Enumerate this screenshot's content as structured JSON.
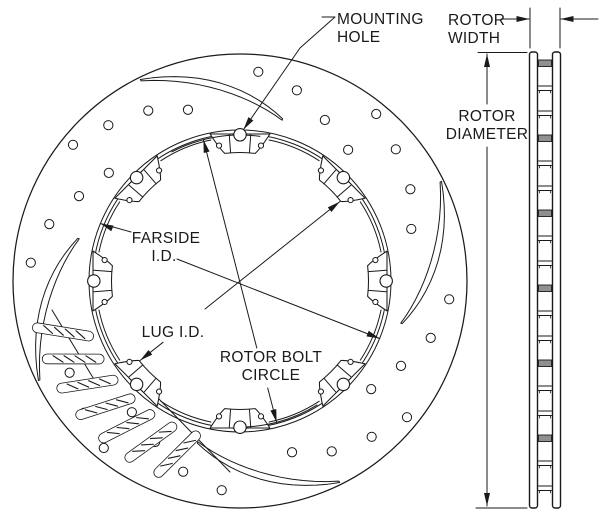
{
  "labels": {
    "mounting_hole": {
      "lines": [
        "MOUNTING",
        "HOLE"
      ]
    },
    "rotor_width": {
      "lines": [
        "ROTOR",
        "WIDTH"
      ]
    },
    "rotor_diameter": {
      "lines": [
        "ROTOR",
        "DIAMETER"
      ]
    },
    "farside_id": {
      "lines": [
        "FARSIDE",
        "I.D."
      ]
    },
    "lug_id": {
      "lines": [
        "LUG I.D."
      ]
    },
    "rotor_bolt_circle": {
      "lines": [
        "ROTOR BOLT",
        "CIRCLE"
      ]
    }
  },
  "colors": {
    "line": "#1a1a1a",
    "background": "#ffffff",
    "vane_fill": "#909090"
  },
  "figure": {
    "face": {
      "cx": 240,
      "cy": 281,
      "outer_r": 227,
      "farside_r": [
        151,
        147.2
      ],
      "scallop_r": 144,
      "lug": {
        "angles": [
          90,
          45,
          0,
          -45,
          -90,
          -135,
          180,
          135
        ],
        "half_span": 11.5,
        "inner_r": 128.5,
        "shoulder_r": 150,
        "detail_half": 4.2,
        "detail_outer_r": 146.5,
        "notch_r": 2.6,
        "notch_angle": 8.8,
        "notch_rad": 137,
        "hole_r": 6.2,
        "hole_rad": 146.2
      },
      "bolt_arc": {
        "r": 146,
        "spans": [
          [
            118,
            82
          ],
          [
            -58,
            -92
          ]
        ]
      },
      "holes": {
        "r": 4.6,
        "quadrant_bases": [
          140.8,
          50.8,
          -39.2,
          -129.2
        ],
        "offsets": [
          [
            0,
            215.5
          ],
          [
            -10.6,
            204
          ],
          [
            -22.5,
            193.5
          ],
          [
            -33.9,
            179
          ],
          [
            -55.8,
            210
          ],
          [
            -67.4,
            199
          ],
          [
            -78.6,
            182
          ],
          [
            -90.3,
            170
          ]
        ]
      },
      "slots": {
        "theta0": [
          116.3,
          26.3,
          -63.7,
          -153.7
        ],
        "span": 41,
        "r_out": 224,
        "r_in": 167,
        "w_max": 2.8,
        "w_min": 0.8
      },
      "cutaway": {
        "bars": [
          196,
          205,
          214,
          223,
          232,
          241,
          250
        ],
        "bar_r_in": 161,
        "bar_r_out": 208,
        "bar_w": 4.5,
        "lead_in": 4,
        "lead_out": -3,
        "breaks": [
          [
            [
              52,
              310
            ],
            [
              98,
              386
            ]
          ],
          [
            [
              158,
              398
            ],
            [
              230,
              472
            ]
          ]
        ]
      }
    },
    "section": {
      "plates": [
        [
          529.5,
          537.5
        ],
        [
          552.5,
          560.5
        ]
      ],
      "top": 52,
      "bottom": 508,
      "rib_start": 60,
      "rib_step": 25,
      "rib_count": 18
    },
    "dims": {
      "lines": [
        {
          "name": "farside-id-line",
          "segs": [
            [
              100.4,
              223.5,
              131,
              232
            ],
            [
              177,
              259,
              379.6,
              338.5
            ]
          ],
          "arrows": [
            [
              100.4,
              223.5,
              157.6
            ],
            [
              379.6,
              338.5,
              -22.4
            ]
          ]
        },
        {
          "name": "rotor-bolt-circle-line",
          "segs": [
            [
              203.4,
              139.7,
              256.8,
              348
            ],
            [
              267.7,
              388,
              276.6,
              422.3
            ]
          ],
          "arrows": [
            [
              203.4,
              139.7,
              104.5
            ],
            [
              276.6,
              422.3,
              -75.5
            ]
          ]
        },
        {
          "name": "lug-id-line",
          "segs": [
            [
              140.2,
              360.4,
              163,
              342.3
            ],
            [
              205,
              309,
              339.8,
              201.6
            ]
          ],
          "arrows": [
            [
              339.8,
              201.6,
              38.5
            ],
            [
              140.2,
              360.4,
              -141.5
            ]
          ]
        },
        {
          "name": "mounting-hole-leader",
          "segs": [
            [
              322,
              17,
              335,
              17
            ]
          ],
          "poly": [
            [
              335,
              17
            ],
            [
              300,
              48
            ],
            [
              243.5,
              129.5
            ]
          ],
          "arrows": [
            [
              243.5,
              129.5,
              -124.7
            ]
          ]
        },
        {
          "name": "rotor-width-dim",
          "segs": [
            [
              501,
              19,
              529,
              19
            ],
            [
              598,
              19,
              561,
              19
            ],
            [
              530,
              8,
              530,
              48
            ],
            [
              560,
              8,
              560,
              48
            ]
          ],
          "arrows": [
            [
              529.5,
              19,
              0
            ],
            [
              560.5,
              19,
              180
            ]
          ]
        },
        {
          "name": "rotor-diameter-dim",
          "segs": [
            [
              478,
              52.5,
              527,
              52.5
            ],
            [
              487,
              54,
              487,
              104
            ],
            [
              487,
              147,
              487,
              506
            ],
            [
              476,
              508,
              527,
              508
            ]
          ],
          "arrows": [
            [
              487,
              54,
              90
            ],
            [
              487,
              506,
              -90
            ]
          ]
        }
      ]
    },
    "texts": [
      {
        "bind": "labels.mounting_hole.lines.0",
        "x": 337,
        "y": 24,
        "anchor": "start",
        "name": "label-mounting-hole"
      },
      {
        "bind": "labels.mounting_hole.lines.1",
        "x": 337,
        "y": 42,
        "anchor": "start",
        "name": "label-mounting-hole"
      },
      {
        "bind": "labels.rotor_width.lines.0",
        "x": 448,
        "y": 25,
        "anchor": "start",
        "name": "label-rotor-width"
      },
      {
        "bind": "labels.rotor_width.lines.1",
        "x": 448,
        "y": 43,
        "anchor": "start",
        "name": "label-rotor-width"
      },
      {
        "bind": "labels.rotor_diameter.lines.0",
        "x": 487,
        "y": 121,
        "anchor": "middle",
        "name": "label-rotor-diameter"
      },
      {
        "bind": "labels.rotor_diameter.lines.1",
        "x": 487,
        "y": 139,
        "anchor": "middle",
        "name": "label-rotor-diameter"
      },
      {
        "bind": "labels.farside_id.lines.0",
        "x": 166,
        "y": 243,
        "anchor": "middle",
        "name": "label-farside-id"
      },
      {
        "bind": "labels.farside_id.lines.1",
        "x": 164,
        "y": 261,
        "anchor": "middle",
        "name": "label-farside-id"
      },
      {
        "bind": "labels.lug_id.lines.0",
        "x": 173,
        "y": 337,
        "anchor": "middle",
        "name": "label-lug-id"
      },
      {
        "bind": "labels.rotor_bolt_circle.lines.0",
        "x": 271,
        "y": 362,
        "anchor": "middle",
        "name": "label-rotor-bolt-circle"
      },
      {
        "bind": "labels.rotor_bolt_circle.lines.1",
        "x": 271,
        "y": 380,
        "anchor": "middle",
        "name": "label-rotor-bolt-circle"
      }
    ]
  }
}
